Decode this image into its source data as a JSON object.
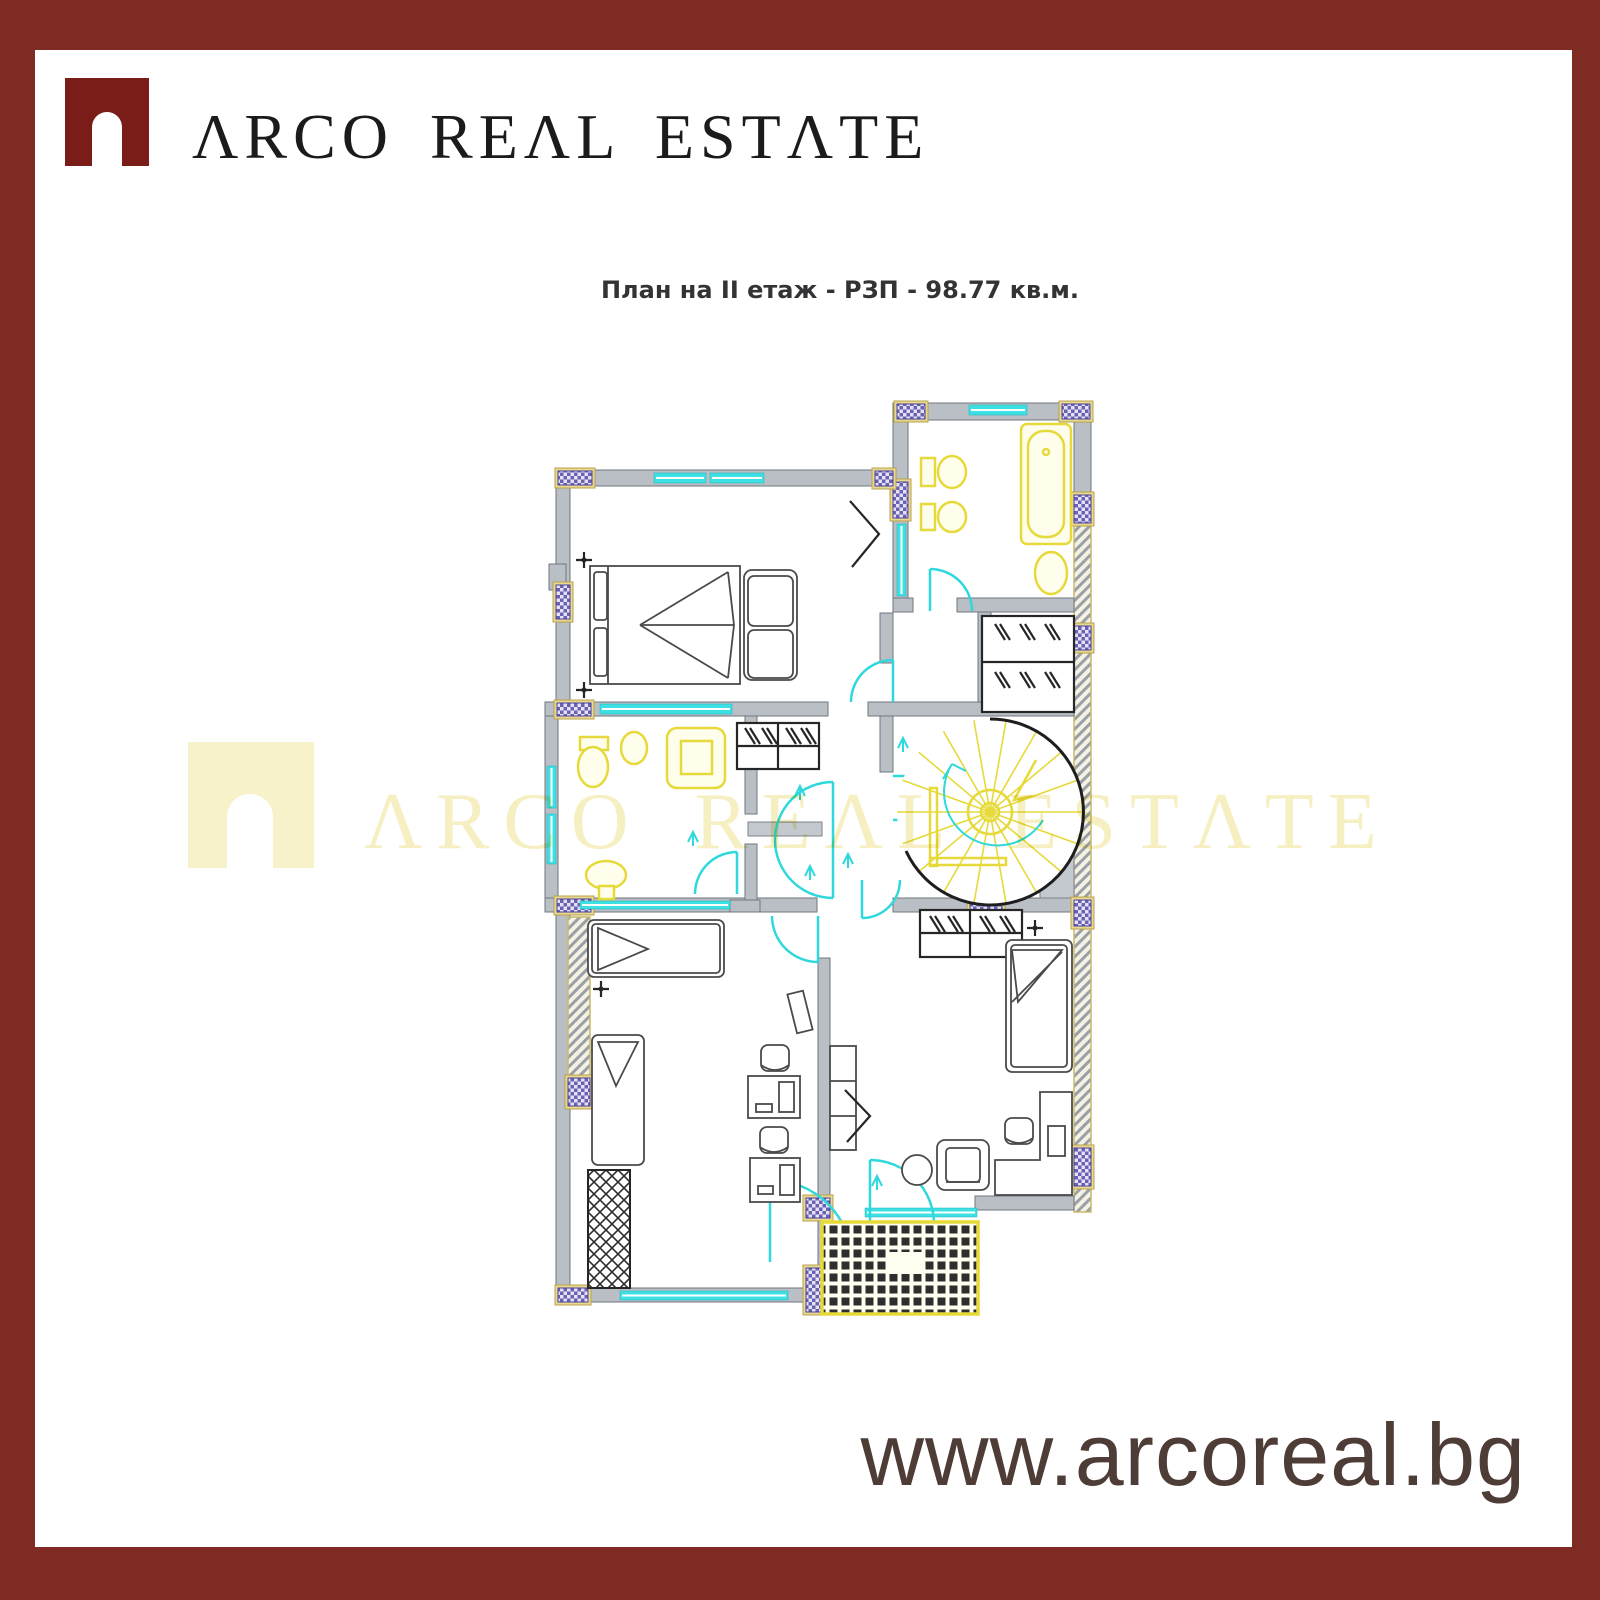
{
  "brand": {
    "name": "ARCO REAL ESTATE",
    "display": "ΛRCO REΛL ESTΛTE"
  },
  "title": {
    "text": "План на II етаж - РЗП - 98.77 кв.м.",
    "floor": "II етаж",
    "area_label": "РЗП",
    "area_value": "98.77",
    "area_unit": "кв.м."
  },
  "watermark": {
    "display": "ΛRCO REΛL ESTΛTE"
  },
  "footer": {
    "website": "www.arcoreal.bg"
  },
  "colors": {
    "frame": "#7f2a22",
    "logo_mark": "#7a1d18",
    "logo_text": "#1b1b1e",
    "title_text": "#333336",
    "watermark": "#f6efc2",
    "website_text": "#4e3c37",
    "plan_wall": "#b9bfc5",
    "plan_glazing": "#3fe0e4",
    "plan_fixture": "#e6da3a",
    "plan_column": "#6a61b4",
    "plan_furniture": "#3a3a3a"
  }
}
